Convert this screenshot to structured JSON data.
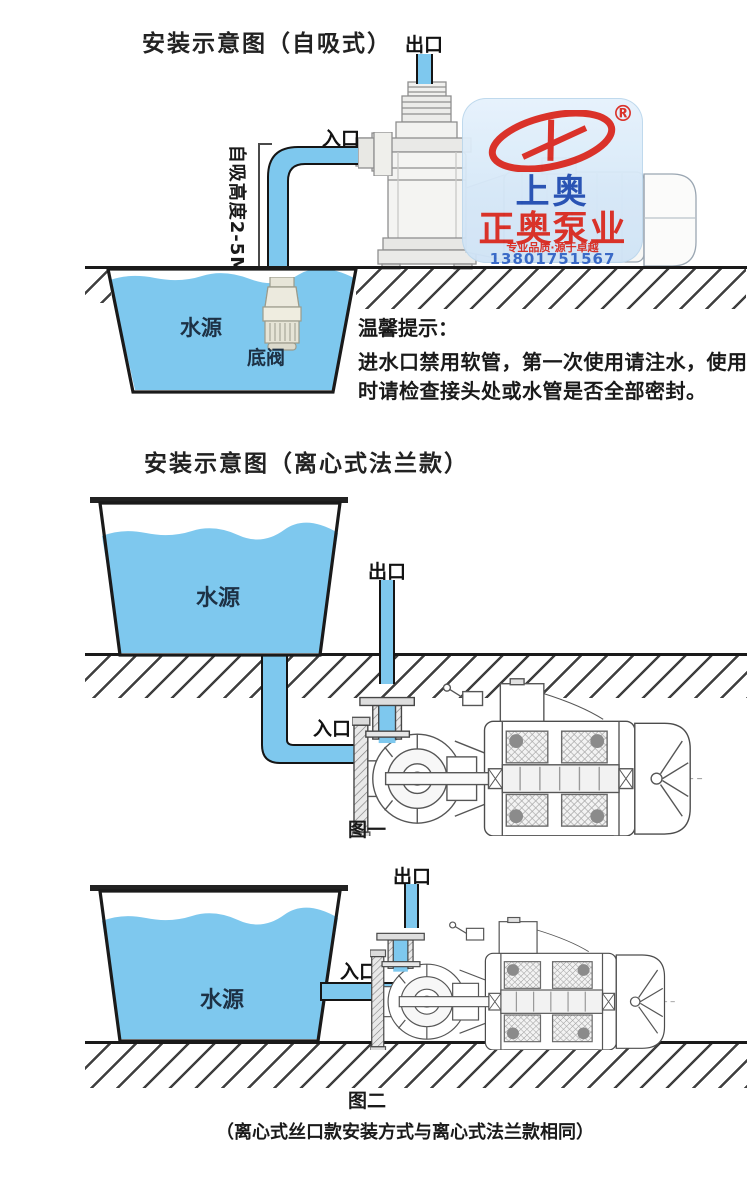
{
  "colors": {
    "water_blue": "#7ec8ee",
    "outline_black": "#1a1a1a",
    "pump_line_gray": "#565656",
    "light_pump_gray": "#8f8f8f",
    "logo_bg_blue": "#d6e8f8",
    "logo_red": "#d8261d",
    "logo_blue": "#1e4ab0",
    "phone_blue": "#2f62c5"
  },
  "logo": {
    "registered_mark": "®",
    "brand_top": "上奥",
    "brand_main": "正奥泵业",
    "slogan": "专业品质·源于卓越",
    "phone": "13801751567"
  },
  "diagram1": {
    "title": "安装示意图（自吸式）",
    "outlet_label": "出口",
    "inlet_label": "入口",
    "suction_height_label": "自吸高度2-5M",
    "water_source_label": "水源",
    "foot_valve_label": "底阀",
    "notice_heading": "温馨提示：",
    "notice_body": "进水口禁用软管，第一次使用请注水，使用时请检查接头处或水管是否全部密封。"
  },
  "diagram2": {
    "title": "安装示意图（离心式法兰款）",
    "outlet_label": "出口",
    "inlet_label": "入口",
    "water_source_label": "水源",
    "figure_caption": "图一"
  },
  "diagram3": {
    "outlet_label": "出口",
    "inlet_label": "入口",
    "water_source_label": "水源",
    "figure_caption": "图二",
    "footnote": "（离心式丝口款安装方式与离心式法兰款相同）"
  }
}
